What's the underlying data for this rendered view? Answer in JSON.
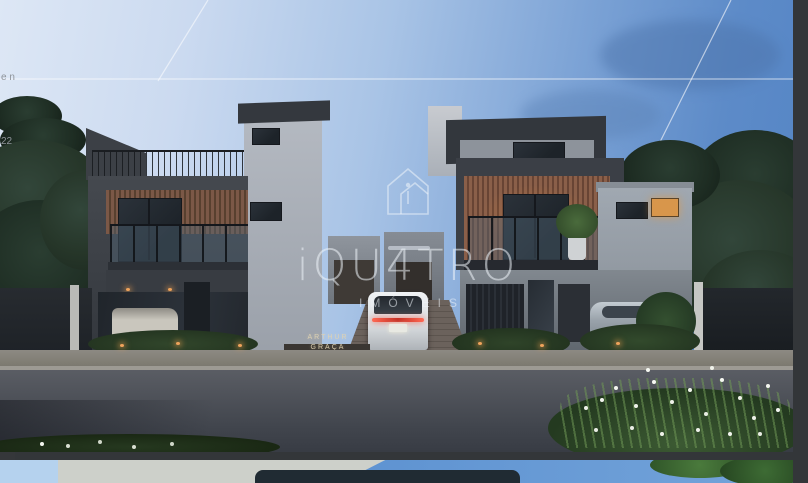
{
  "app": {
    "background_color": "#333639"
  },
  "watermark": {
    "brand": "iQU4TRO",
    "subtitle": "IMÓVEIS",
    "icon": "house-outline-icon",
    "color_hex": "#eef4fa",
    "opacity": 0.55
  },
  "main_photo": {
    "alt": "Twilight architectural render of two modern three-story townhouses with charcoal and wood-slat facades, a white SUV in the central driveway, trees on both sides and flowers in the foreground",
    "sign": {
      "line1": "ARTHUR",
      "line2": "GRAÇA"
    },
    "palette": {
      "sky_left": "#dde7f5",
      "sky_right": "#5384c5",
      "facade_dark": "#3c4047",
      "facade_light": "#9aa2ab",
      "wood_slats": "#7b5847",
      "lit_window": "#d8964b",
      "taillight_red": "#e04438",
      "road": "#4a4e56",
      "foliage": "#2c3b33"
    }
  },
  "side_panel": {
    "background": "#35373a",
    "fragments": [
      "e n",
      "22"
    ]
  },
  "next_photo": {
    "alt": "Top sliver of the next gallery photo: daylight blue sky, pale building and green foliage",
    "palette": {
      "sky": "#5d92d1",
      "building": "#cdd0ca"
    }
  }
}
